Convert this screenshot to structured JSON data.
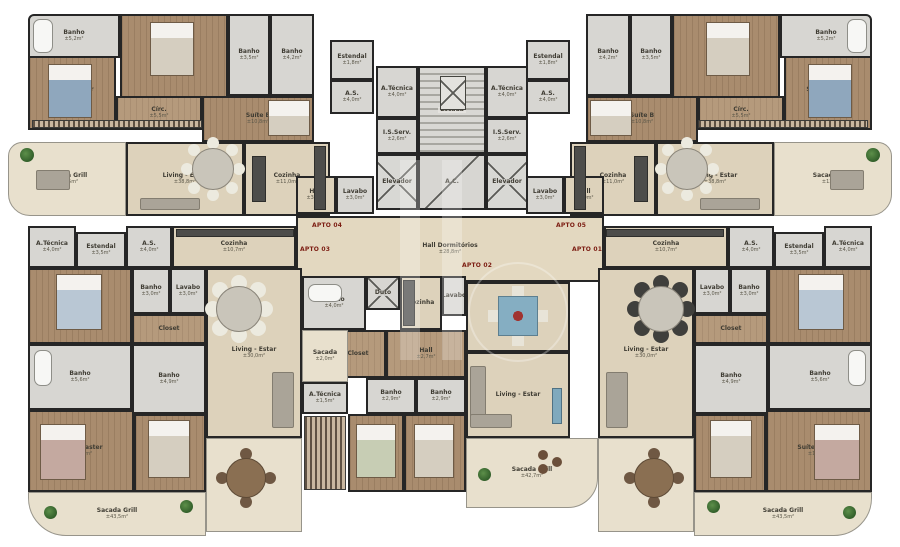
{
  "hall": {
    "label": "Hall Dormitórios",
    "area": "±28,8m²"
  },
  "tags": {
    "apto01": "APTO 01",
    "apto02": "APTO 02",
    "apto03": "APTO 03",
    "apto04": "APTO 04",
    "apto05": "APTO 05"
  },
  "core": {
    "atecnica_l": {
      "label": "A.Técnica",
      "area": "±4,0m²"
    },
    "atecnica_r": {
      "label": "A.Técnica",
      "area": "±4,0m²"
    },
    "isserv_l": {
      "label": "I.S.Serv.",
      "area": "±2,6m²"
    },
    "isserv_r": {
      "label": "I.S.Serv.",
      "area": "±2,6m²"
    },
    "escada": {
      "label": "Escada"
    },
    "ac": {
      "label": "A.C."
    },
    "elevador_l": {
      "label": "Elevador"
    },
    "elevador_r": {
      "label": "Elevador"
    }
  },
  "apto04": {
    "banho_master": {
      "label": "Banho",
      "area": "±5,2m²"
    },
    "suite_master": {
      "label": "Suíte Master",
      "area": "±14,5m²"
    },
    "suite_a": {
      "label": "Suíte A",
      "area": "±12,9m²"
    },
    "banho_a": {
      "label": "Banho",
      "area": "±3,5m²"
    },
    "banho_b": {
      "label": "Banho",
      "area": "±4,2m²"
    },
    "suite_b": {
      "label": "Suíte B",
      "area": "±10,8m²"
    },
    "circ": {
      "label": "Círc.",
      "area": "±5,5m²"
    },
    "sacada": {
      "label": "Sacada Grill",
      "area": "±13,5m²"
    },
    "living": {
      "label": "Living - Estar",
      "area": "±38,8m²"
    },
    "cozinha": {
      "label": "Cozinha",
      "area": "±11,0m²"
    },
    "hall": {
      "label": "Hall",
      "area": "±3,0m²"
    },
    "lavabo": {
      "label": "Lavabo",
      "area": "±3,0m²"
    },
    "as": {
      "label": "A.S.",
      "area": "±4,0m²"
    },
    "estendal": {
      "label": "Estendal",
      "area": "±1,8m²"
    }
  },
  "apto05": {
    "banho_master": {
      "label": "Banho",
      "area": "±5,2m²"
    },
    "suite_master": {
      "label": "Suíte Master",
      "area": "±14,5m²"
    },
    "suite_a": {
      "label": "Suíte A",
      "area": "±12,9m²"
    },
    "banho_a": {
      "label": "Banho",
      "area": "±3,5m²"
    },
    "banho_b": {
      "label": "Banho",
      "area": "±4,2m²"
    },
    "suite_b": {
      "label": "Suíte B",
      "area": "±10,8m²"
    },
    "circ": {
      "label": "Círc.",
      "area": "±5,5m²"
    },
    "sacada": {
      "label": "Sacada Grill",
      "area": "±13,5m²"
    },
    "living": {
      "label": "Living - Estar",
      "area": "±38,8m²"
    },
    "cozinha": {
      "label": "Cozinha",
      "area": "±11,0m²"
    },
    "hall": {
      "label": "Hall",
      "area": "±3,0m²"
    },
    "lavabo": {
      "label": "Lavabo",
      "area": "±3,0m²"
    },
    "as": {
      "label": "A.S.",
      "area": "±4,0m²"
    },
    "estendal": {
      "label": "Estendal",
      "area": "±1,8m²"
    }
  },
  "apto03": {
    "atecnica": {
      "label": "A.Técnica",
      "area": "±4,0m²"
    },
    "estendal": {
      "label": "Estendal",
      "area": "±3,5m²"
    },
    "as": {
      "label": "A.S.",
      "area": "±4,0m²"
    },
    "cozinha": {
      "label": "Cozinha",
      "area": "±10,7m²"
    },
    "suite_b": {
      "label": "Suíte B",
      "area": "±12,0m²"
    },
    "banho_sb": {
      "label": "Banho",
      "area": "±3,0m²"
    },
    "lavabo": {
      "label": "Lavabo",
      "area": "±3,0m²"
    },
    "living": {
      "label": "Living - Estar",
      "area": "±30,0m²"
    },
    "closet": {
      "label": "Closet"
    },
    "banho_master": {
      "label": "Banho",
      "area": "±5,6m²"
    },
    "banho_a": {
      "label": "Banho",
      "area": "±4,9m²"
    },
    "suite_master": {
      "label": "Suíte Master",
      "area": "±14,5m²"
    },
    "suite_a": {
      "label": "Suíte A",
      "area": "±12,9m²"
    },
    "sacada": {
      "label": "Sacada Grill",
      "area": "±43,5m²"
    }
  },
  "apto01": {
    "atecnica": {
      "label": "A.Técnica",
      "area": "±4,0m²"
    },
    "estendal": {
      "label": "Estendal",
      "area": "±3,5m²"
    },
    "as": {
      "label": "A.S.",
      "area": "±4,0m²"
    },
    "cozinha": {
      "label": "Cozinha",
      "area": "±10,7m²"
    },
    "suite_b": {
      "label": "Suíte B",
      "area": "±12,0m²"
    },
    "banho_sb": {
      "label": "Banho",
      "area": "±3,0m²"
    },
    "lavabo": {
      "label": "Lavabo",
      "area": "±3,0m²"
    },
    "living": {
      "label": "Living - Estar",
      "area": "±30,0m²"
    },
    "closet": {
      "label": "Closet"
    },
    "banho_master": {
      "label": "Banho",
      "area": "±5,6m²"
    },
    "banho_a": {
      "label": "Banho",
      "area": "±4,9m²"
    },
    "suite_master": {
      "label": "Suíte Master",
      "area": "±14,5m²"
    },
    "suite_a": {
      "label": "Suíte A",
      "area": "±12,9m²"
    },
    "sacada": {
      "label": "Sacada Grill",
      "area": "±43,5m²"
    }
  },
  "apto02": {
    "banho_tub": {
      "label": "Banho",
      "area": "±4,0m²"
    },
    "duto": {
      "label": "Duto"
    },
    "cozinha": {
      "label": "Cozinha"
    },
    "lavabo": {
      "label": "Lavabo",
      "area": "±2,0m²"
    },
    "closet": {
      "label": "Closet"
    },
    "hall": {
      "label": "Hall",
      "area": "±2,7m²"
    },
    "banho_b": {
      "label": "Banho",
      "area": "±2,9m²"
    },
    "banho_a": {
      "label": "Banho",
      "area": "±2,9m²"
    },
    "suite_b": {
      "label": "Suíte B",
      "area": "±12,0m²"
    },
    "suite_a": {
      "label": "Suíte A",
      "area": "±12,9m²"
    },
    "living": {
      "label": "Living - Estar"
    },
    "sacada": {
      "label": "Sacada Grill",
      "area": "±42,7m²"
    },
    "sacada_small": {
      "label": "Sacada",
      "area": "±2,0m²"
    },
    "atecnica": {
      "label": "A.Técnica",
      "area": "±1,5m²"
    }
  }
}
